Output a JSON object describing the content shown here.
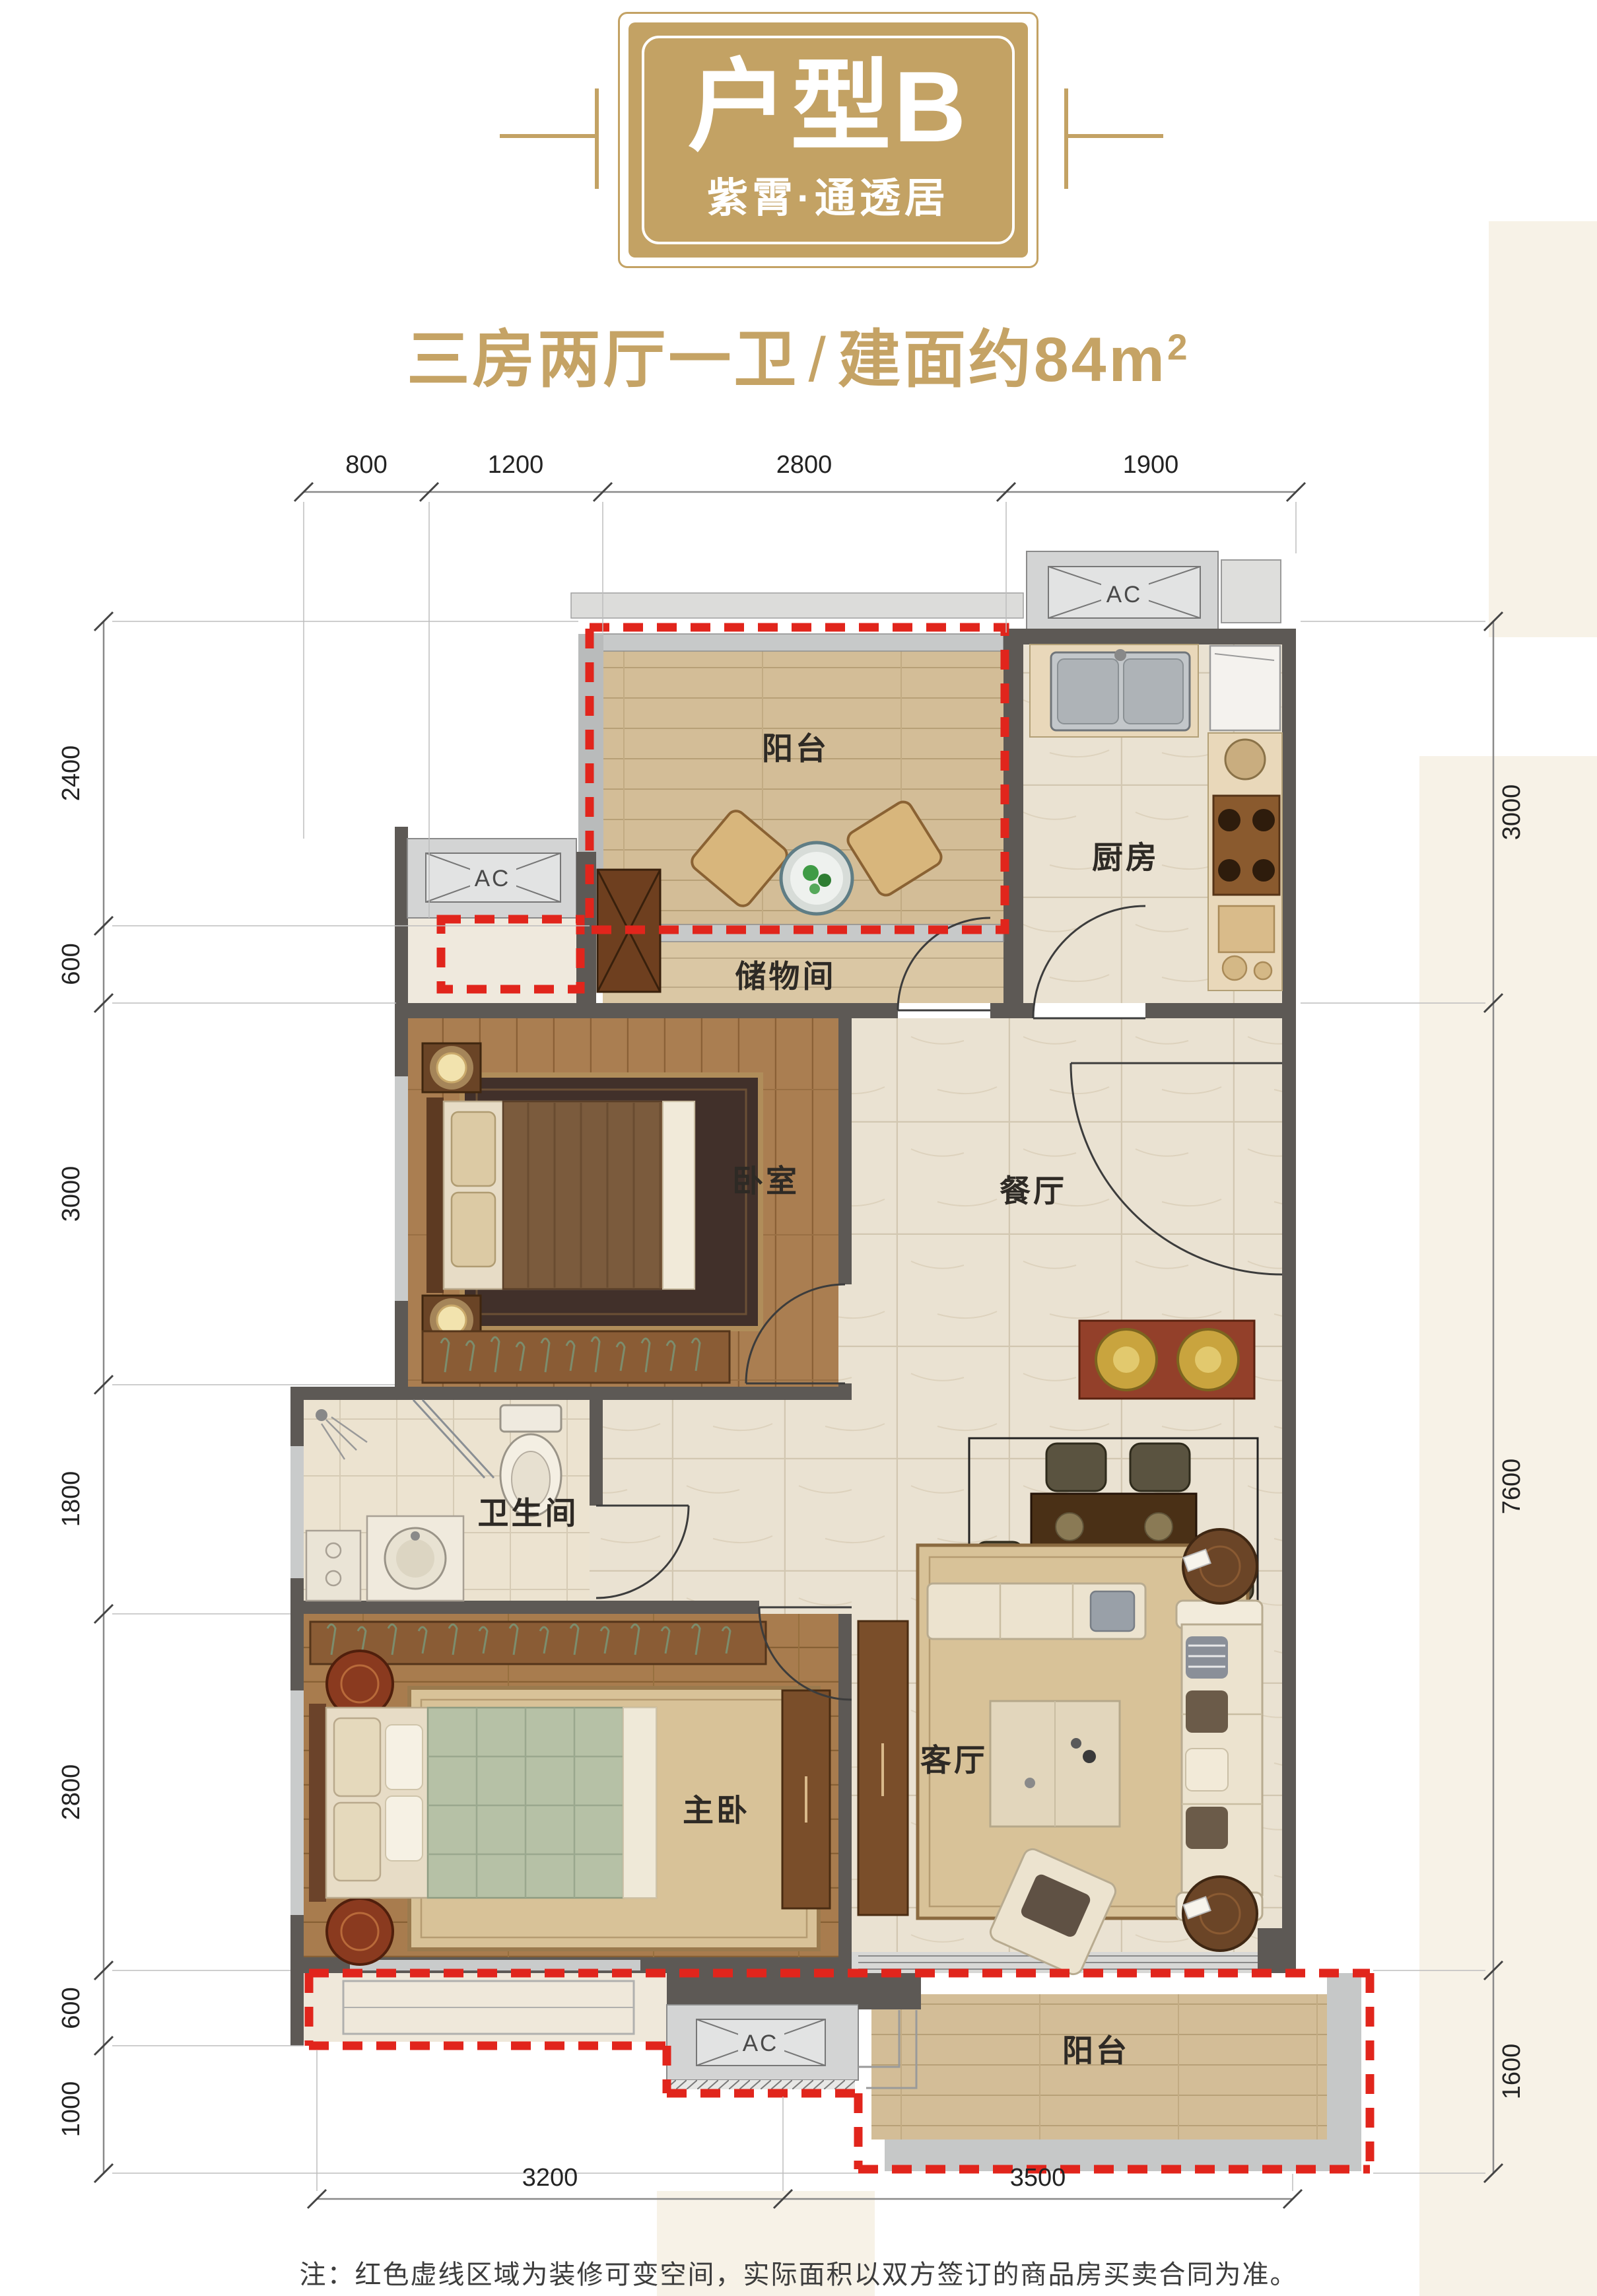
{
  "header": {
    "badge_title": "户型B",
    "badge_subtitle": "紫霄·通透居",
    "title_rooms": "三房两厅一卫",
    "title_slash": "/",
    "title_area": "建面约84m",
    "title_area_exp": "2"
  },
  "floorplan": {
    "room_labels": {
      "balcony_top": "阳台",
      "kitchen": "厨房",
      "storage": "储物间",
      "bedroom": "卧室",
      "dining": "餐厅",
      "bathroom": "卫生间",
      "master_bedroom": "主卧",
      "living_room": "客厅",
      "balcony_bottom": "阳台"
    },
    "ac_label": "AC",
    "dimensions": {
      "top": [
        "800",
        "1200",
        "2800",
        "1900"
      ],
      "left": [
        "2400",
        "600",
        "3000",
        "1800",
        "2800",
        "600",
        "1000"
      ],
      "right": [
        "3000",
        "7600",
        "1600"
      ],
      "bottom": [
        "3200",
        "3500"
      ]
    }
  },
  "note": "注：红色虚线区域为装修可变空间，实际面积以双方签订的商品房买卖合同为准。",
  "colors": {
    "gold": "#c3a264",
    "red_dashed": "#e1251c",
    "wall_dark": "#5d5955",
    "wall_light": "#c7c9c9"
  }
}
